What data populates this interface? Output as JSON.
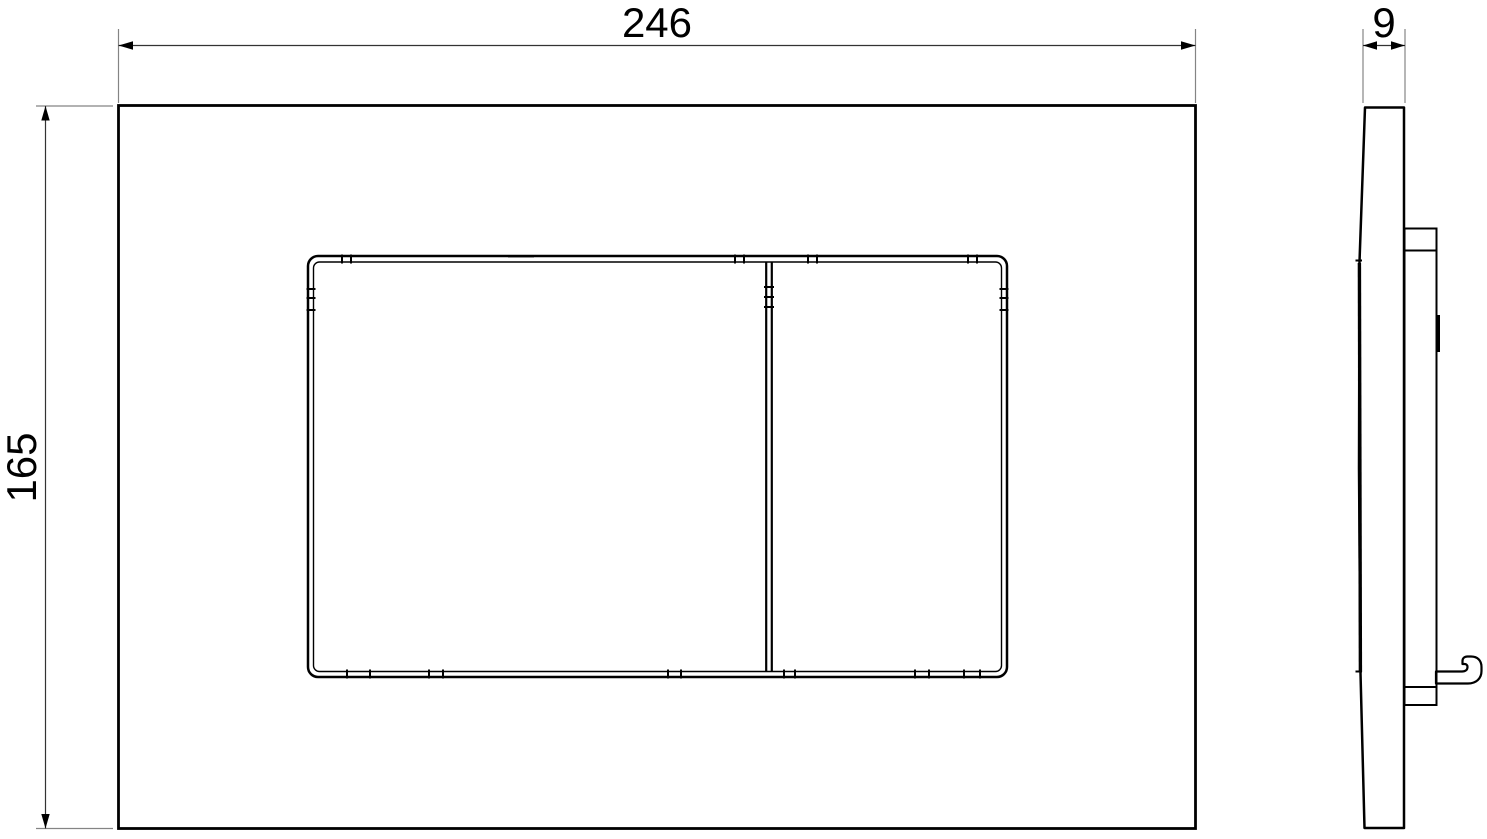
{
  "drawing": {
    "dimensions": {
      "width": "246",
      "height": "165",
      "depth": "9"
    },
    "colors": {
      "background": "#ffffff",
      "outline": "#000000",
      "extension_line": "#848484",
      "dimension_line": "#333333",
      "text": "#000000"
    }
  }
}
